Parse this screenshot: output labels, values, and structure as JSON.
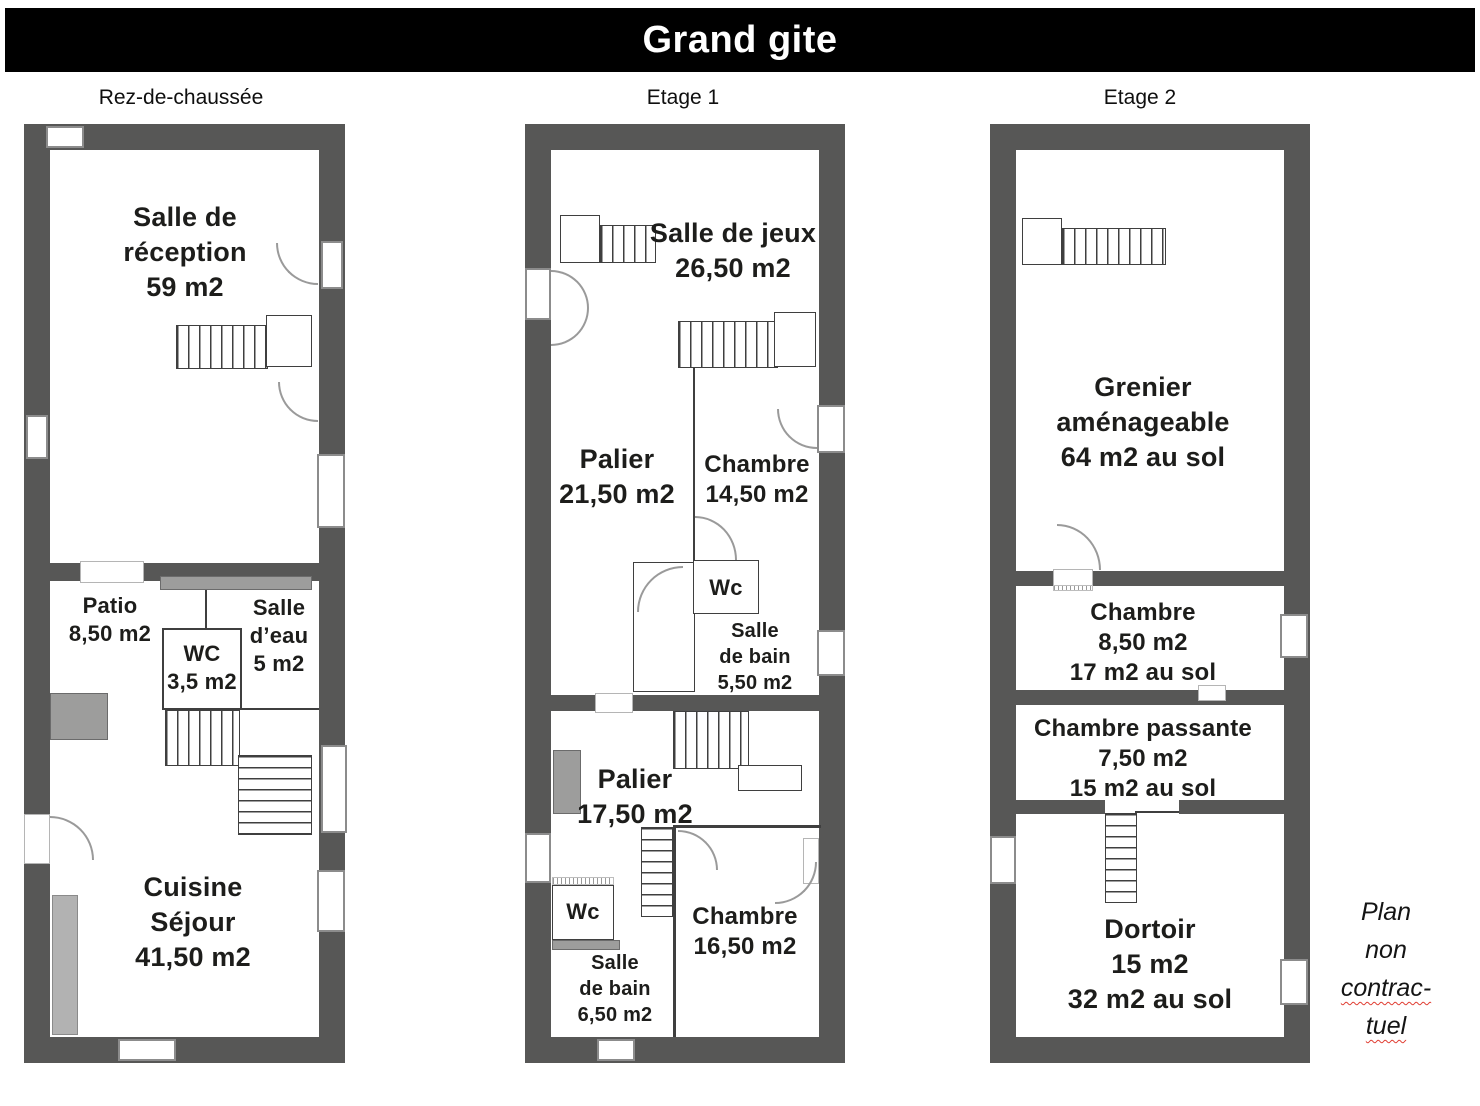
{
  "title": "Grand gite",
  "colors": {
    "title_bar_bg": "#000000",
    "title_text": "#ffffff",
    "wall": "#575756",
    "accent_mid_gray": "#9d9d9c",
    "accent_light_gray": "#b2b2b2",
    "label_text": "#1d1d1b",
    "spellcheck_red": "#e03c31"
  },
  "floors": [
    {
      "label": "Rez-de-chaussée",
      "rooms": {
        "reception": [
          "Salle de",
          "réception",
          "59 m2"
        ],
        "patio": [
          "Patio",
          "8,50 m2"
        ],
        "wc": [
          "WC",
          "3,5 m2"
        ],
        "salle_eau": [
          "Salle",
          "d’eau",
          "5 m2"
        ],
        "cuisine": [
          "Cuisine",
          "Séjour",
          "41,50 m2"
        ]
      }
    },
    {
      "label": "Etage 1",
      "rooms": {
        "salle_de_jeux": [
          "Salle de jeux",
          "26,50 m2"
        ],
        "palier_haut": [
          "Palier",
          "21,50 m2"
        ],
        "chambre_1": [
          "Chambre",
          "14,50 m2"
        ],
        "wc_1": [
          "Wc"
        ],
        "salle_de_bain_1": [
          "Salle",
          "de bain",
          "5,50 m2"
        ],
        "palier_bas": [
          "Palier",
          "17,50 m2"
        ],
        "wc_2": [
          "Wc"
        ],
        "salle_de_bain_2": [
          "Salle",
          "de bain",
          "6,50 m2"
        ],
        "chambre_2": [
          "Chambre",
          "16,50 m2"
        ]
      }
    },
    {
      "label": "Etage 2",
      "rooms": {
        "grenier": [
          "Grenier",
          "aménageable",
          "64 m2 au sol"
        ],
        "chambre": [
          "Chambre",
          "8,50 m2",
          "17 m2 au sol"
        ],
        "chambre_passante": [
          "Chambre passante",
          "7,50 m2",
          "15 m2 au sol"
        ],
        "dortoir": [
          "Dortoir",
          "15 m2",
          "32 m2 au sol"
        ]
      }
    }
  ],
  "footnote": [
    "Plan",
    "non",
    "contrac-",
    "tuel"
  ]
}
